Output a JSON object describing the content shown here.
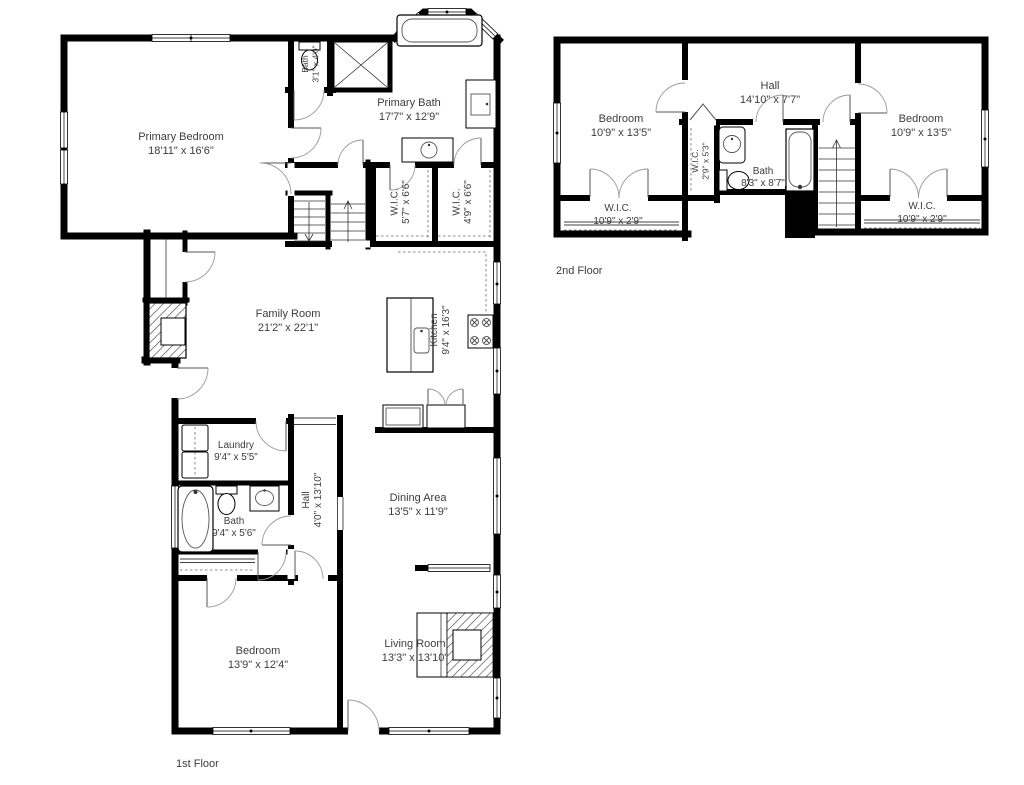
{
  "colors": {
    "background": "#ffffff",
    "wall": "#000000",
    "label_text": "#3d3d3d",
    "fixture_line": "#4a4a4a",
    "door_arc": "#999999"
  },
  "floors": [
    {
      "label": "1st Floor",
      "rooms": [
        {
          "name": "Primary Bedroom",
          "dims": "18'11\" x 16'6\""
        },
        {
          "name": "Primary Bath",
          "dims": "17'7\" x 12'9\""
        },
        {
          "name": "Bath",
          "dims": "3'1\" x 4'0\""
        },
        {
          "name": "W.I.C.",
          "dims": "5'7\" x 6'6\""
        },
        {
          "name": "W.I.C.",
          "dims": "4'9\" x 6'6\""
        },
        {
          "name": "Family Room",
          "dims": "21'2\" x 22'1\""
        },
        {
          "name": "Kitchen",
          "dims": "9'4\" x 16'3\""
        },
        {
          "name": "Laundry",
          "dims": "9'4\" x 5'5\""
        },
        {
          "name": "Hall",
          "dims": "4'0\" x 13'10\""
        },
        {
          "name": "Bath",
          "dims": "9'4\" x 5'6\""
        },
        {
          "name": "Dining Area",
          "dims": "13'5\" x 11'9\""
        },
        {
          "name": "Bedroom",
          "dims": "13'9\" x 12'4\""
        },
        {
          "name": "Living Room",
          "dims": "13'3\" x 13'10\""
        }
      ]
    },
    {
      "label": "2nd Floor",
      "rooms": [
        {
          "name": "Bedroom",
          "dims": "10'9\" x 13'5\""
        },
        {
          "name": "Hall",
          "dims": "14'10\" x 7'7\""
        },
        {
          "name": "Bedroom",
          "dims": "10'9\" x 13'5\""
        },
        {
          "name": "W.I.C.",
          "dims": "2'9\" x 5'3\""
        },
        {
          "name": "Bath",
          "dims": "8'3\" x 8'7\""
        },
        {
          "name": "W.I.C.",
          "dims": "10'9\" x 2'9\""
        },
        {
          "name": "W.I.C.",
          "dims": "10'9\" x 2'9\""
        }
      ]
    }
  ]
}
